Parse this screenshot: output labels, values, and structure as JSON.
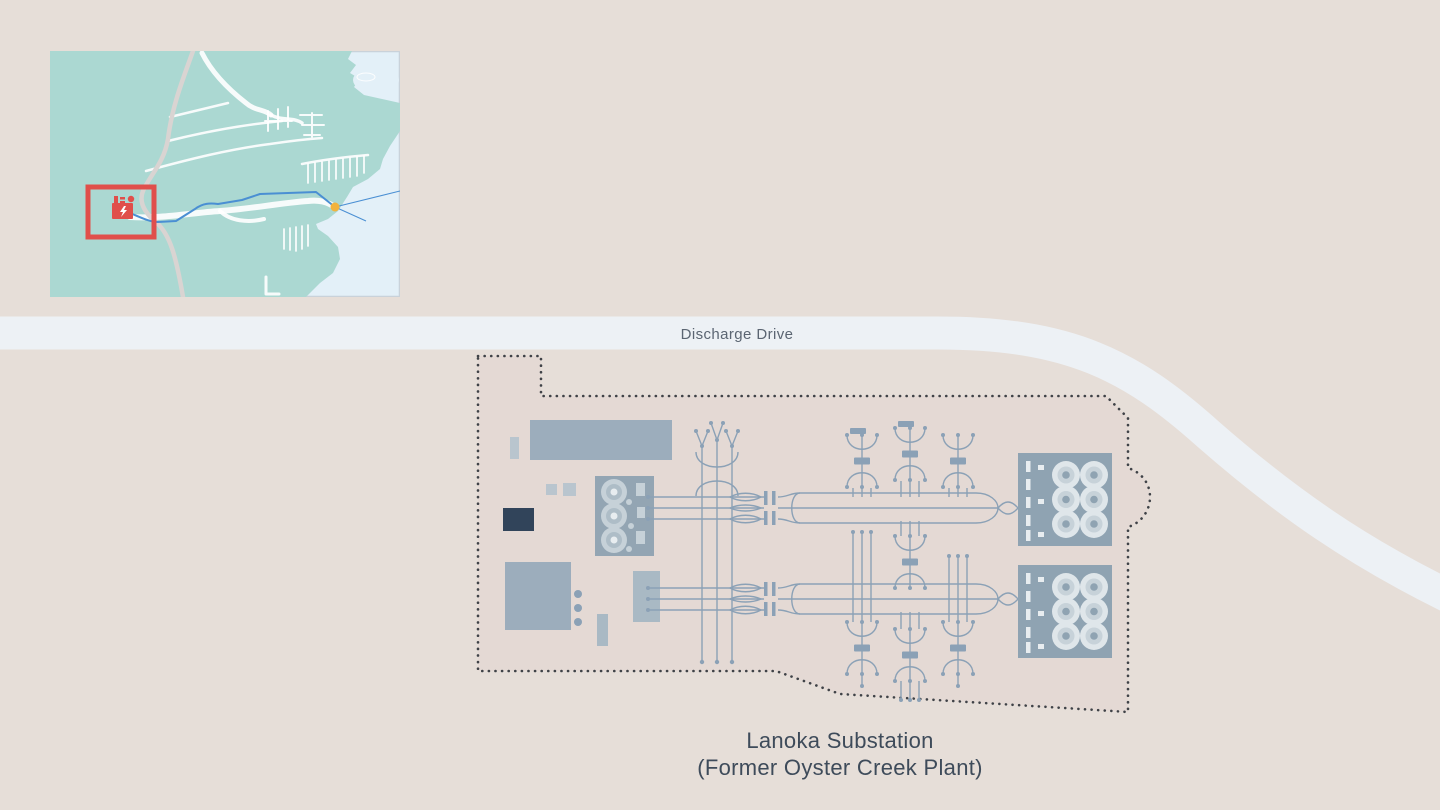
{
  "title": {
    "road": "Discharge Drive",
    "site_line1": "Lanoka Substation",
    "site_line2": "(Former Oyster Creek Plant)"
  },
  "icons": {
    "inset_plant": "power-plant-icon",
    "inset_marker": "junction-dot-icon"
  },
  "colors": {
    "background": "#e6ded8",
    "road": "#edf1f5",
    "road_text": "#5b6572",
    "site_fill": "#e4d9d4",
    "site_outline": "#3f4247",
    "site_text": "#3e4b5a",
    "diagram_line": "#8ba1b6",
    "building": "#9cadbc",
    "building_light": "#b9c5ce",
    "building_mid": "#a9b9c4",
    "building_dark": "#31445a",
    "pad": "#93a5b3",
    "pad_element": "#c6d1d8",
    "pad_ring": "#aebdc7",
    "pad_dot": "#e8edf0",
    "bank_bg": "#8fa3b2",
    "bank_dash": "#e8edf0",
    "coil_outer": "#dfe6ea",
    "coil_mid": "#c7d2d9",
    "coil_center": "#8fa3b2",
    "inset_land": "#abd8d2",
    "inset_water": "#e3f0f8",
    "inset_road": "#ffffff",
    "inset_highway": "#d9d4d2",
    "inset_transmission": "#4a8fd3",
    "inset_highlight": "#e04f4b",
    "inset_marker": "#f2b33d",
    "inset_border": "#c9d2da"
  }
}
